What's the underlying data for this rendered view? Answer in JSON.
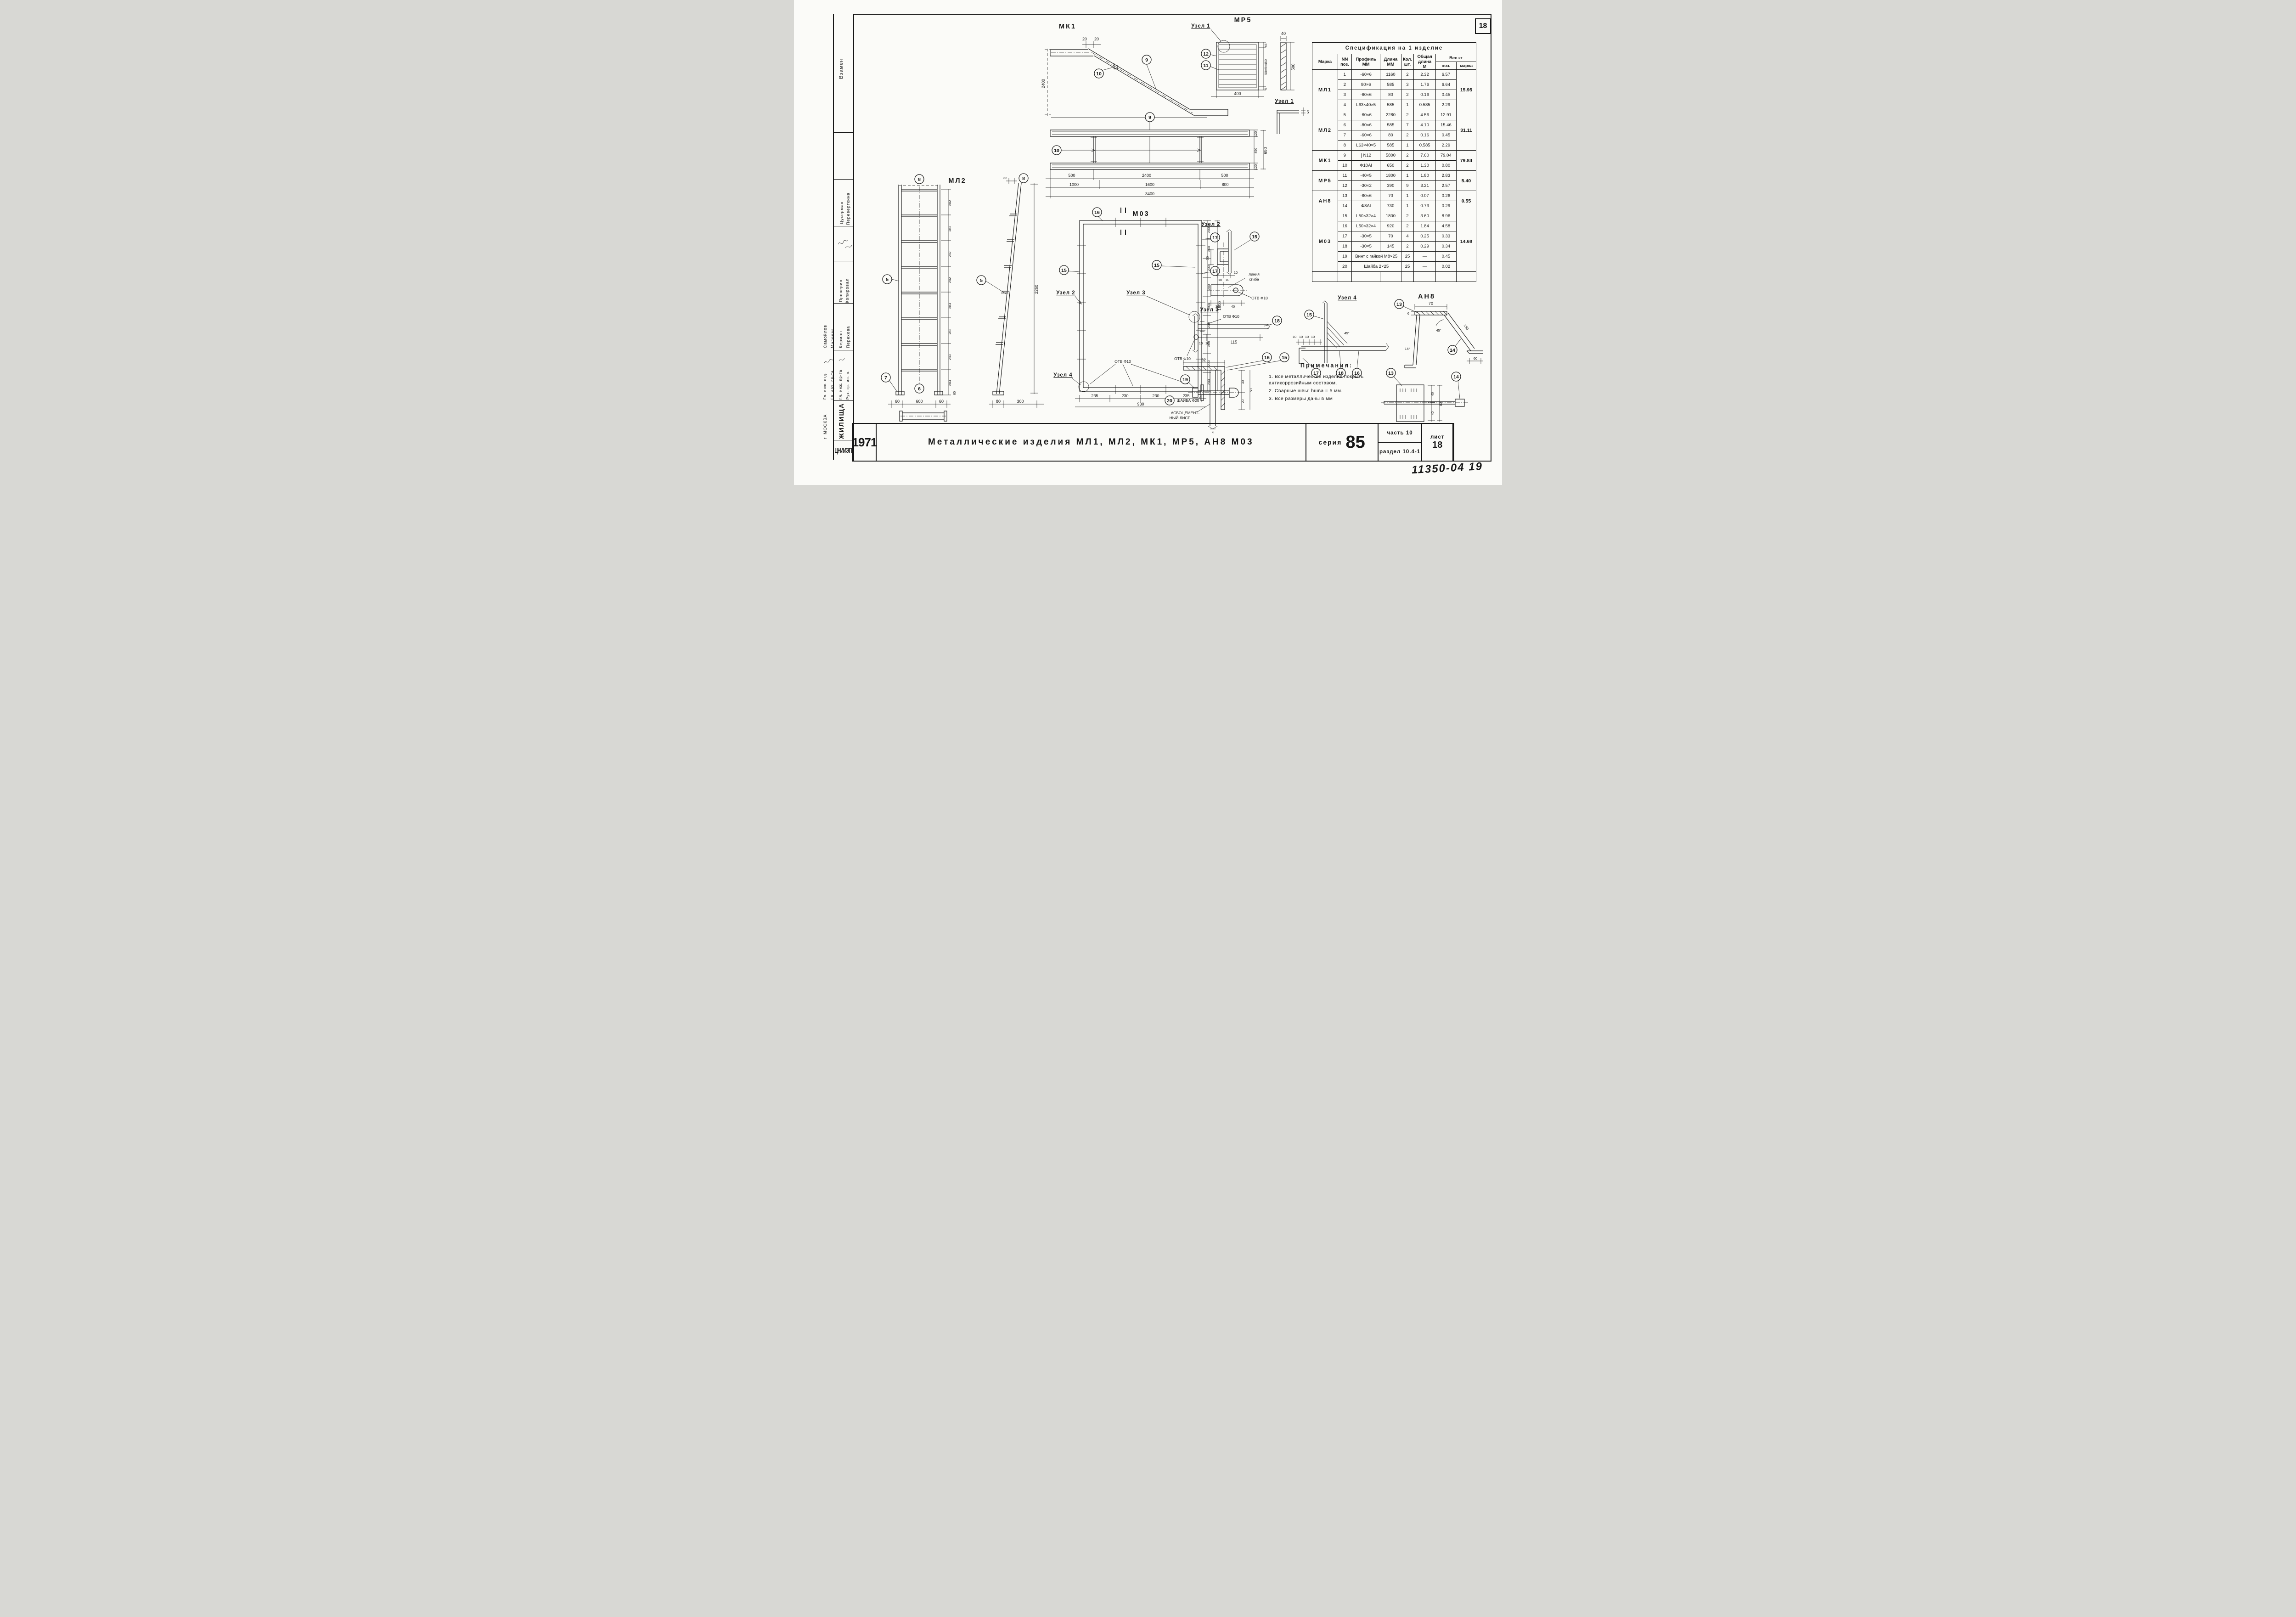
{
  "page": {
    "sheet_corner_number": "18",
    "handwritten_note": "11350-04  19"
  },
  "title_block": {
    "year": "1971",
    "title": "Металлические  изделия  МЛ1, МЛ2, МК1, МР5, АН8  М03",
    "series_label": "серия",
    "series_value": "85",
    "part_label": "часть  10",
    "section_label": "раздел 10.4-1",
    "sheet_label": "лист",
    "sheet_value": "18"
  },
  "sidebar": {
    "vzamen": "Взамен",
    "sig_names": [
      "Цукерман",
      "Переверткина"
    ],
    "check_labels": [
      "Проверил",
      "Копировал"
    ],
    "exec_names": [
      "Самойлов",
      "Масеева",
      "Керман",
      "Перехова"
    ],
    "roles": [
      "Гл. инж. отд.",
      "Гл. арх. пр-та",
      "Гл. инж. пр-та",
      "Рук. гр. ин. ч."
    ],
    "org": {
      "logo": "ЦНИИЭП",
      "name": "ЖИЛИЩА",
      "city": "г. МОСКВА"
    }
  },
  "spec_table": {
    "title": "Спецификация  на  1 изделие",
    "h_marka": "Марка",
    "h_pos": "NN\nпоз.",
    "h_profile": "Профиль\nММ",
    "h_len": "Длина\nММ",
    "h_qty": "Кол.\nшт.",
    "h_total": "Общая\nдлина\nМ",
    "h_weight": "Вес  кг",
    "h_wpos": "поз.",
    "h_wmarka": "марка",
    "groups": [
      {
        "marka": "МЛ1",
        "weight": "15.95",
        "rows": [
          {
            "pos": "1",
            "profile": "-60×6",
            "len": "1160",
            "qty": "2",
            "total": "2.32",
            "w": "6.57"
          },
          {
            "pos": "2",
            "profile": "80×6",
            "len": "585",
            "qty": "3",
            "total": "1.76",
            "w": "6.64"
          },
          {
            "pos": "3",
            "profile": "-60×6",
            "len": "80",
            "qty": "2",
            "total": "0.16",
            "w": "0.45"
          },
          {
            "pos": "4",
            "profile": "L63×40×5",
            "len": "585",
            "qty": "1",
            "total": "0.585",
            "w": "2.29"
          }
        ]
      },
      {
        "marka": "МЛ2",
        "weight": "31.11",
        "rows": [
          {
            "pos": "5",
            "profile": "-60×6",
            "len": "2280",
            "qty": "2",
            "total": "4.56",
            "w": "12.91"
          },
          {
            "pos": "6",
            "profile": "-80×6",
            "len": "585",
            "qty": "7",
            "total": "4.10",
            "w": "15.46"
          },
          {
            "pos": "7",
            "profile": "-60×6",
            "len": "80",
            "qty": "2",
            "total": "0.16",
            "w": "0.45"
          },
          {
            "pos": "8",
            "profile": "L63×40×5",
            "len": "585",
            "qty": "1",
            "total": "0.585",
            "w": "2.29"
          }
        ]
      },
      {
        "marka": "МК1",
        "weight": "79.84",
        "rows": [
          {
            "pos": "9",
            "profile": "[ N12",
            "len": "5800",
            "qty": "2",
            "total": "7.60",
            "w": "79.04"
          },
          {
            "pos": "10",
            "profile": "Ф10АI",
            "len": "650",
            "qty": "2",
            "total": "1.30",
            "w": "0.80"
          }
        ]
      },
      {
        "marka": "МР5",
        "weight": "5.40",
        "rows": [
          {
            "pos": "11",
            "profile": "-40×5",
            "len": "1800",
            "qty": "1",
            "total": "1.80",
            "w": "2.83"
          },
          {
            "pos": "12",
            "profile": "-30×2",
            "len": "390",
            "qty": "9",
            "total": "3.21",
            "w": "2.57"
          }
        ]
      },
      {
        "marka": "АН8",
        "weight": "0.55",
        "rows": [
          {
            "pos": "13",
            "profile": "-80×6",
            "len": "70",
            "qty": "1",
            "total": "0.07",
            "w": "0.26"
          },
          {
            "pos": "14",
            "profile": "Ф8АI",
            "len": "730",
            "qty": "1",
            "total": "0.73",
            "w": "0.29"
          }
        ]
      },
      {
        "marka": "М03",
        "weight": "14.68",
        "rows": [
          {
            "pos": "15",
            "profile": "L50×32×4",
            "len": "1800",
            "qty": "2",
            "total": "3.60",
            "w": "8.96"
          },
          {
            "pos": "16",
            "profile": "L50×32×4",
            "len": "920",
            "qty": "2",
            "total": "1.84",
            "w": "4.58"
          },
          {
            "pos": "17",
            "profile": "-30×5",
            "len": "70",
            "qty": "4",
            "total": "0.25",
            "w": "0.33"
          },
          {
            "pos": "18",
            "profile": "-30×5",
            "len": "145",
            "qty": "2",
            "total": "0.29",
            "w": "0.34"
          },
          {
            "pos": "19",
            "profile": "Винт с гайкой  М8×25",
            "len": null,
            "qty": "25",
            "total": "—",
            "w": "0.45"
          },
          {
            "pos": "20",
            "profile": "Шайба  2×25",
            "len": null,
            "qty": "25",
            "total": "—",
            "w": "0.02"
          }
        ]
      }
    ]
  },
  "notes": {
    "title": "Примечания:",
    "items": [
      "1. Все  металлические  изделия  покрыть антикоррозийным  составом.",
      "2. Сварные  швы:  hшва = 5 мм.",
      "3. Все  размеры   даны   в мм"
    ]
  },
  "drawings": {
    "mk1": {
      "label": "МК1",
      "dim_a": "20",
      "dim_b": "20",
      "dim_h": "2400",
      "c9": "9",
      "c10": "10"
    },
    "uzel1_ref": "Узел 1",
    "mr5": {
      "label": "МР5",
      "c12": "12",
      "c11": "11",
      "dim_w": "400",
      "dim_45": "45",
      "dim_chain": "50×9=450",
      "dim_5": "5",
      "strip_w": "40",
      "strip_h": "500",
      "uzel1_title": "Узел 1",
      "uzel1_d5": "5"
    },
    "plan": {
      "c9": "9",
      "c10": "10",
      "r1": [
        "500",
        "2400",
        "500"
      ],
      "r2": [
        "1000",
        "1600",
        "800"
      ],
      "total": "3400",
      "right": [
        "120",
        "450",
        "120"
      ],
      "right_total": "690"
    },
    "ml2": {
      "label": "МЛ2",
      "c8a": "8",
      "c8b": "8",
      "c5a": "5",
      "c5b": "5",
      "c6": "6",
      "c7": "7",
      "chain": [
        "282",
        "282",
        "282",
        "282",
        "283",
        "283",
        "283",
        "283"
      ],
      "d60r": "60",
      "bottom": [
        "60",
        "600",
        "60"
      ],
      "d32": "32",
      "height": "2260",
      "side_bottom": [
        "80",
        "300"
      ]
    },
    "m03": {
      "label": "М03",
      "c16t": "16",
      "c15l": "15",
      "c15r": "15",
      "c17a": "17",
      "c17b": "17",
      "uzel2": "Узел 2",
      "uzel3": "Узел 3",
      "uzel4": "Узел 4",
      "otv": "ОТВ Ф10",
      "d200": [
        "200",
        "200",
        "200",
        "200",
        "200",
        "200",
        "200",
        "200",
        "200"
      ],
      "total_h": "1800",
      "bottom": [
        "235",
        "230",
        "230",
        "235"
      ],
      "total_w": "930"
    },
    "uzel2": {
      "title": "Узел 2",
      "c15": "15",
      "d30": "30",
      "d10a": "10",
      "d10b": "10",
      "d10c": "10",
      "bend1": "линия",
      "bend2": "сгиба",
      "otv": "ОТВ Ф10",
      "b30": "30",
      "b40": "40"
    },
    "uzel3": {
      "title": "Узел 3",
      "c18": "18",
      "otv_top": "ОТВ Ф10",
      "otv_bot": "ОТВ Ф10",
      "d10a": "10",
      "d10b": "10",
      "d115": "115"
    },
    "section": {
      "c19": "19",
      "c20": "20",
      "c16": "16",
      "c15": "15",
      "d32": "32",
      "d30": "30",
      "d50": "50",
      "d20": "20",
      "d4": "4",
      "washer": "ШАЙБА Ф25",
      "sheet1": "АСБОЦЕМЕНТ-",
      "sheet2": "НЫЙ ЛИСТ"
    },
    "uzel4": {
      "title": "Узел 4",
      "c15": "15",
      "c17": "17",
      "c18": "18",
      "c16": "16",
      "d10": [
        "10",
        "10",
        "10",
        "10"
      ],
      "d45": "45°"
    },
    "an8": {
      "label": "АН8",
      "c13": "13",
      "c14": "14",
      "d70": "70",
      "d6": "6",
      "d45": "45°",
      "d15": "15°",
      "d250": "250",
      "d60": "60",
      "pc13": "13",
      "pc14": "14",
      "p40a": "40",
      "p40b": "40",
      "p80": "80"
    }
  }
}
